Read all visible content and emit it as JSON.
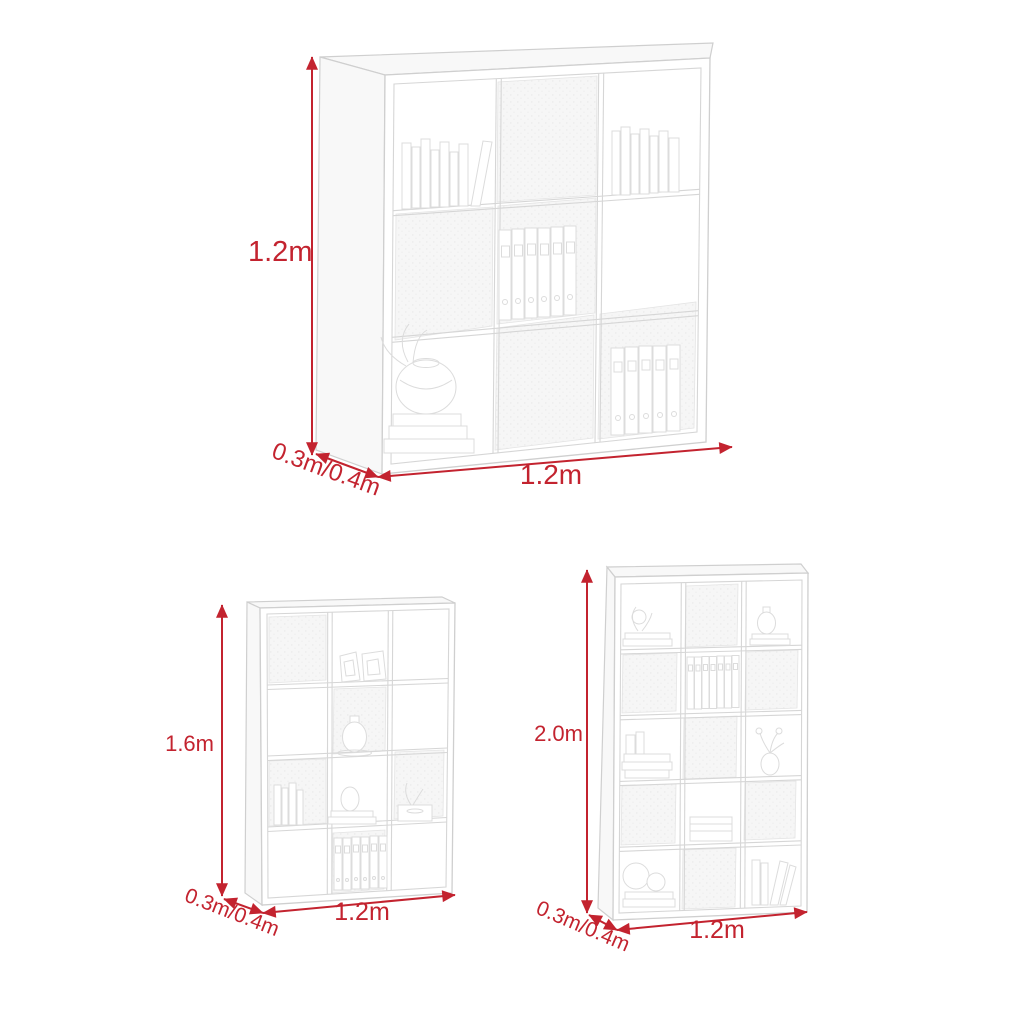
{
  "colors": {
    "dimension_red": "#c3232f",
    "line_art_gray": "#d8d8d8",
    "background": "#ffffff"
  },
  "units": [
    {
      "name": "9-cube bookshelf",
      "grid": "3 columns x 3 rows",
      "dimensions": {
        "height": "1.2m",
        "width": "1.2m",
        "depth": "0.3m/0.4m"
      }
    },
    {
      "name": "12-cube bookshelf",
      "grid": "3 columns x 4 rows",
      "dimensions": {
        "height": "1.6m",
        "width": "1.2m",
        "depth": "0.3m/0.4m"
      }
    },
    {
      "name": "15-cube bookshelf",
      "grid": "3 columns x 5 rows",
      "dimensions": {
        "height": "2.0m",
        "width": "1.2m",
        "depth": "0.3m/0.4m"
      }
    }
  ]
}
